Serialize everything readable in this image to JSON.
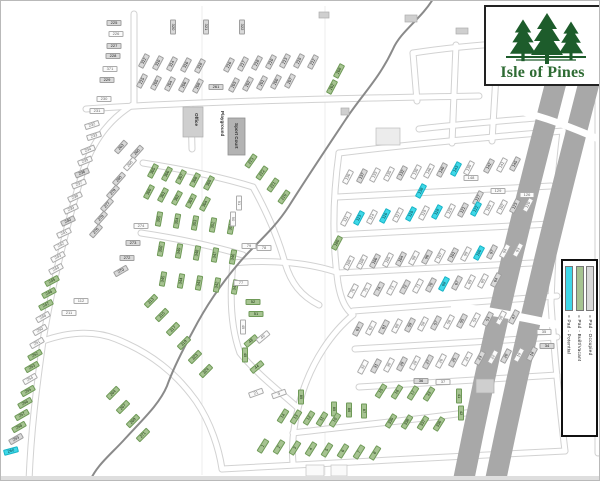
{
  "logo": {
    "title": "Isle of Pines"
  },
  "legend": {
    "items": [
      {
        "label": "= Pad - Potential",
        "type": "p"
      },
      {
        "label": "= Pad - Built/Vacant",
        "type": "b"
      },
      {
        "label": "= Pad - Occupied",
        "type": "o"
      }
    ]
  },
  "facilities": {
    "office": "Office",
    "playground": "Playground",
    "sport_court": "Sport Court"
  },
  "colors": {
    "pad_occupied": "#d9d9d9",
    "pad_occupied_border": "#9f9f9f",
    "pad_built": "#a6c391",
    "pad_built_border": "#6f9a58",
    "pad_potential": "#3fd8e8",
    "pad_potential_border": "#17b4c6",
    "pad_unshaded": "#fbfbfb",
    "pad_unshaded_border": "#ababab",
    "highway": "#a8a8a8",
    "creek": "#8a8a8a",
    "road_edge": "#d2d2d2",
    "logo_green": "#1d5c2b",
    "logo_text": "#2e6b33"
  },
  "lots": [
    [
      "225",
      113,
      22,
      0,
      "o"
    ],
    [
      "226",
      115,
      33,
      0,
      "w"
    ],
    [
      "227",
      113,
      45,
      0,
      "o"
    ],
    [
      "228",
      112,
      55,
      0,
      "o"
    ],
    [
      "371",
      109,
      68,
      0,
      "w"
    ],
    [
      "229",
      106,
      79,
      0,
      "o"
    ],
    [
      "230",
      103,
      98,
      0,
      "w"
    ],
    [
      "231",
      96,
      110,
      0,
      "w"
    ],
    [
      "320",
      172,
      26,
      90,
      "o"
    ],
    [
      "321",
      205,
      26,
      90,
      "o"
    ],
    [
      "322",
      241,
      26,
      90,
      "o"
    ],
    [
      "312",
      143,
      60,
      -62,
      "o"
    ],
    [
      "310",
      157,
      62,
      -62,
      "o"
    ],
    [
      "314",
      171,
      63,
      -62,
      "o"
    ],
    [
      "316",
      185,
      64,
      -62,
      "o"
    ],
    [
      "318",
      199,
      65,
      -62,
      "o"
    ],
    [
      "216",
      228,
      64,
      -62,
      "o"
    ],
    [
      "217",
      242,
      63,
      -62,
      "o"
    ],
    [
      "218",
      256,
      62,
      -62,
      "o"
    ],
    [
      "210",
      270,
      61,
      -62,
      "o"
    ],
    [
      "213",
      284,
      60,
      -62,
      "o"
    ],
    [
      "219",
      298,
      60,
      -62,
      "o"
    ],
    [
      "212",
      312,
      61,
      -62,
      "o"
    ],
    [
      "215",
      141,
      80,
      -62,
      "o"
    ],
    [
      "205",
      155,
      82,
      -62,
      "o"
    ],
    [
      "204",
      169,
      83,
      -62,
      "o"
    ],
    [
      "206",
      183,
      84,
      -62,
      "o"
    ],
    [
      "208",
      197,
      85,
      -62,
      "o"
    ],
    [
      "261",
      215,
      86,
      0,
      "o"
    ],
    [
      "203",
      233,
      84,
      -62,
      "o"
    ],
    [
      "202",
      247,
      83,
      -62,
      "o"
    ],
    [
      "201",
      261,
      82,
      -62,
      "o"
    ],
    [
      "200",
      275,
      81,
      -62,
      "o"
    ],
    [
      "207",
      289,
      80,
      -62,
      "o"
    ],
    [
      "268",
      338,
      70,
      -62,
      "b"
    ],
    [
      "262",
      331,
      86,
      -62,
      "b"
    ],
    [
      "305",
      152,
      170,
      -62,
      "b"
    ],
    [
      "306",
      166,
      173,
      -62,
      "b"
    ],
    [
      "307",
      180,
      176,
      -62,
      "b"
    ],
    [
      "308",
      194,
      179,
      -62,
      "b"
    ],
    [
      "309",
      208,
      182,
      -62,
      "b"
    ],
    [
      "300",
      148,
      191,
      -62,
      "b"
    ],
    [
      "301",
      162,
      194,
      -62,
      "b"
    ],
    [
      "302",
      176,
      197,
      -62,
      "b"
    ],
    [
      "303",
      190,
      200,
      -62,
      "b"
    ],
    [
      "304",
      204,
      203,
      -62,
      "b"
    ],
    [
      "223",
      250,
      160,
      -55,
      "b"
    ],
    [
      "222",
      261,
      172,
      -55,
      "b"
    ],
    [
      "221",
      272,
      184,
      -55,
      "b"
    ],
    [
      "220",
      283,
      196,
      -55,
      "b"
    ],
    [
      "355",
      158,
      218,
      -80,
      "b"
    ],
    [
      "354",
      176,
      220,
      -80,
      "b"
    ],
    [
      "353",
      194,
      222,
      -80,
      "b"
    ],
    [
      "352",
      212,
      224,
      -80,
      "b"
    ],
    [
      "351",
      230,
      226,
      -80,
      "b"
    ],
    [
      "350",
      160,
      248,
      -80,
      "b"
    ],
    [
      "349",
      178,
      250,
      -80,
      "b"
    ],
    [
      "348",
      196,
      252,
      -80,
      "b"
    ],
    [
      "347",
      214,
      254,
      -80,
      "b"
    ],
    [
      "346",
      232,
      256,
      -80,
      "b"
    ],
    [
      "345",
      162,
      278,
      -80,
      "b"
    ],
    [
      "344",
      180,
      280,
      -80,
      "b"
    ],
    [
      "343",
      198,
      282,
      -80,
      "b"
    ],
    [
      "342",
      216,
      284,
      -80,
      "b"
    ],
    [
      "341",
      234,
      286,
      -80,
      "b"
    ],
    [
      "263",
      120,
      146,
      -48,
      "o"
    ],
    [
      "265",
      136,
      151,
      -48,
      "o"
    ],
    [
      "266",
      129,
      163,
      -48,
      "w"
    ],
    [
      "280",
      118,
      178,
      -48,
      "o"
    ],
    [
      "279",
      112,
      191,
      -48,
      "o"
    ],
    [
      "277",
      106,
      204,
      -48,
      "o"
    ],
    [
      "278",
      100,
      217,
      -48,
      "o"
    ],
    [
      "276",
      95,
      230,
      -48,
      "o"
    ],
    [
      "274",
      140,
      225,
      0,
      "w"
    ],
    [
      "273",
      132,
      242,
      0,
      "o"
    ],
    [
      "272",
      126,
      257,
      0,
      "o"
    ],
    [
      "270",
      120,
      270,
      -30,
      "o"
    ],
    [
      "112",
      80,
      300,
      0,
      "w"
    ],
    [
      "211",
      68,
      312,
      0,
      "w"
    ],
    [
      "313",
      150,
      300,
      -45,
      "b"
    ],
    [
      "315",
      161,
      314,
      -45,
      "b"
    ],
    [
      "317",
      172,
      328,
      -45,
      "b"
    ],
    [
      "319",
      183,
      342,
      -45,
      "b"
    ],
    [
      "323",
      194,
      356,
      -45,
      "b"
    ],
    [
      "324",
      205,
      370,
      -45,
      "b"
    ],
    [
      "264",
      112,
      392,
      -45,
      "b"
    ],
    [
      "267",
      122,
      406,
      -45,
      "b"
    ],
    [
      "269",
      132,
      420,
      -45,
      "b"
    ],
    [
      "271",
      142,
      434,
      -45,
      "b"
    ],
    [
      "232",
      91,
      124,
      -18,
      "w"
    ],
    [
      "233",
      93,
      135,
      -18,
      "w"
    ],
    [
      "234",
      87,
      149,
      -22,
      "w"
    ],
    [
      "235",
      84,
      160,
      -22,
      "w"
    ],
    [
      "236",
      81,
      172,
      -22,
      "o"
    ],
    [
      "237",
      78,
      183,
      -22,
      "w"
    ],
    [
      "238",
      74,
      196,
      -25,
      "w"
    ],
    [
      "239",
      70,
      208,
      -25,
      "w"
    ],
    [
      "240",
      67,
      220,
      -25,
      "o"
    ],
    [
      "241",
      63,
      232,
      -25,
      "w"
    ],
    [
      "242",
      60,
      244,
      -28,
      "w"
    ],
    [
      "243",
      57,
      256,
      -28,
      "w"
    ],
    [
      "244",
      55,
      268,
      -28,
      "w"
    ],
    [
      "245",
      51,
      280,
      -28,
      "b"
    ],
    [
      "246",
      48,
      292,
      -28,
      "b"
    ],
    [
      "247",
      45,
      304,
      -28,
      "b"
    ],
    [
      "248",
      42,
      316,
      -30,
      "w"
    ],
    [
      "250",
      39,
      329,
      -30,
      "w"
    ],
    [
      "251",
      36,
      342,
      -30,
      "w"
    ],
    [
      "252",
      34,
      354,
      -30,
      "b"
    ],
    [
      "253",
      31,
      366,
      -30,
      "b"
    ],
    [
      "254",
      29,
      378,
      -30,
      "w"
    ],
    [
      "255",
      27,
      390,
      -30,
      "b"
    ],
    [
      "256",
      24,
      402,
      -30,
      "b"
    ],
    [
      "257",
      21,
      414,
      -30,
      "b"
    ],
    [
      "258",
      18,
      426,
      -30,
      "b"
    ],
    [
      "259",
      15,
      438,
      -30,
      "o"
    ],
    [
      "260",
      10,
      450,
      -15,
      "p"
    ],
    [
      "136",
      347,
      176,
      -62,
      "w"
    ],
    [
      "137",
      361,
      175,
      -62,
      "o"
    ],
    [
      "133",
      374,
      174,
      -62,
      "w"
    ],
    [
      "135",
      388,
      173,
      -62,
      "w"
    ],
    [
      "132",
      401,
      172,
      -62,
      "o"
    ],
    [
      "130",
      415,
      171,
      -62,
      "w"
    ],
    [
      "146",
      428,
      170,
      -62,
      "w"
    ],
    [
      "140",
      441,
      169,
      -62,
      "o"
    ],
    [
      "143",
      455,
      168,
      -62,
      "p"
    ],
    [
      "139",
      468,
      167,
      -62,
      "w"
    ],
    [
      "142",
      488,
      165,
      -62,
      "o"
    ],
    [
      "141",
      501,
      164,
      -62,
      "w"
    ],
    [
      "145",
      514,
      163,
      -62,
      "o"
    ],
    [
      "148",
      470,
      177,
      0,
      "w"
    ],
    [
      "138",
      420,
      190,
      -62,
      "p"
    ],
    [
      "127",
      477,
      197,
      -62,
      "o"
    ],
    [
      "129",
      497,
      190,
      0,
      "w"
    ],
    [
      "126",
      526,
      194,
      0,
      "w"
    ],
    [
      "111",
      345,
      218,
      -62,
      "w"
    ],
    [
      "113",
      358,
      217,
      -62,
      "p"
    ],
    [
      "114",
      371,
      216,
      -62,
      "w"
    ],
    [
      "116",
      384,
      215,
      -62,
      "p"
    ],
    [
      "117",
      397,
      214,
      -62,
      "w"
    ],
    [
      "110",
      410,
      213,
      -62,
      "p"
    ],
    [
      "119",
      423,
      212,
      -62,
      "w"
    ],
    [
      "118",
      436,
      211,
      -62,
      "p"
    ],
    [
      "125",
      449,
      210,
      -62,
      "w"
    ],
    [
      "121",
      462,
      209,
      -62,
      "o"
    ],
    [
      "122",
      475,
      208,
      -62,
      "p"
    ],
    [
      "103",
      488,
      207,
      -62,
      "w"
    ],
    [
      "102",
      501,
      206,
      -62,
      "w"
    ],
    [
      "123",
      514,
      205,
      -62,
      "o"
    ],
    [
      "120",
      527,
      204,
      -62,
      "w"
    ],
    [
      "180",
      336,
      242,
      -62,
      "b"
    ],
    [
      "109",
      348,
      262,
      -62,
      "w"
    ],
    [
      "108",
      361,
      261,
      -62,
      "w"
    ],
    [
      "106",
      374,
      260,
      -62,
      "o"
    ],
    [
      "105",
      387,
      259,
      -62,
      "w"
    ],
    [
      "104",
      400,
      258,
      -62,
      "o"
    ],
    [
      "98",
      413,
      257,
      -62,
      "w"
    ],
    [
      "96",
      426,
      256,
      -62,
      "o"
    ],
    [
      "107",
      439,
      255,
      -62,
      "w"
    ],
    [
      "101",
      452,
      254,
      -62,
      "o"
    ],
    [
      "99",
      465,
      253,
      -62,
      "w"
    ],
    [
      "100",
      478,
      252,
      -62,
      "p"
    ],
    [
      "97",
      491,
      251,
      -62,
      "o"
    ],
    [
      "94",
      504,
      250,
      -62,
      "w"
    ],
    [
      "93",
      517,
      249,
      -62,
      "w"
    ],
    [
      "76",
      352,
      290,
      -62,
      "w"
    ],
    [
      "75",
      365,
      289,
      -62,
      "w"
    ],
    [
      "74",
      378,
      288,
      -62,
      "o"
    ],
    [
      "73",
      391,
      287,
      -62,
      "w"
    ],
    [
      "72",
      404,
      286,
      -62,
      "o"
    ],
    [
      "71",
      417,
      285,
      -62,
      "w"
    ],
    [
      "70",
      430,
      284,
      -62,
      "o"
    ],
    [
      "68",
      443,
      283,
      -62,
      "p"
    ],
    [
      "67",
      456,
      282,
      -62,
      "o"
    ],
    [
      "69",
      469,
      281,
      -62,
      "w"
    ],
    [
      "65",
      482,
      280,
      -62,
      "w"
    ],
    [
      "64",
      495,
      279,
      -62,
      "o"
    ],
    [
      "63",
      357,
      328,
      -62,
      "o"
    ],
    [
      "62",
      370,
      327,
      -62,
      "w"
    ],
    [
      "61",
      383,
      326,
      -62,
      "o"
    ],
    [
      "60",
      396,
      325,
      -62,
      "w"
    ],
    [
      "59",
      409,
      324,
      -62,
      "o"
    ],
    [
      "58",
      422,
      323,
      -62,
      "w"
    ],
    [
      "57",
      435,
      322,
      -62,
      "o"
    ],
    [
      "56",
      448,
      321,
      -62,
      "w"
    ],
    [
      "55",
      461,
      320,
      -62,
      "o"
    ],
    [
      "54",
      474,
      319,
      -62,
      "w"
    ],
    [
      "53",
      487,
      318,
      -62,
      "o"
    ],
    [
      "50",
      500,
      317,
      -62,
      "w"
    ],
    [
      "47",
      513,
      316,
      -62,
      "o"
    ],
    [
      "32",
      362,
      366,
      -62,
      "w"
    ],
    [
      "31",
      375,
      365,
      -62,
      "o"
    ],
    [
      "30",
      388,
      364,
      -62,
      "w"
    ],
    [
      "29",
      401,
      363,
      -62,
      "o"
    ],
    [
      "28",
      414,
      362,
      -62,
      "w"
    ],
    [
      "27",
      427,
      361,
      -62,
      "o"
    ],
    [
      "26",
      440,
      360,
      -62,
      "w"
    ],
    [
      "25",
      453,
      359,
      -62,
      "o"
    ],
    [
      "24",
      466,
      358,
      -62,
      "w"
    ],
    [
      "23",
      479,
      357,
      -62,
      "o"
    ],
    [
      "22",
      492,
      356,
      -62,
      "w"
    ],
    [
      "20",
      505,
      355,
      -62,
      "o"
    ],
    [
      "19",
      518,
      354,
      -62,
      "w"
    ],
    [
      "18",
      531,
      353,
      -62,
      "o"
    ],
    [
      "35",
      543,
      331,
      0,
      "w"
    ],
    [
      "34",
      546,
      345,
      0,
      "o"
    ],
    [
      "91",
      238,
      202,
      90,
      "w"
    ],
    [
      "90",
      232,
      218,
      90,
      "w"
    ],
    [
      "79",
      248,
      245,
      0,
      "w"
    ],
    [
      "78",
      263,
      247,
      0,
      "w"
    ],
    [
      "77",
      240,
      282,
      0,
      "w"
    ],
    [
      "52",
      252,
      301,
      0,
      "b"
    ],
    [
      "51",
      255,
      313,
      0,
      "b"
    ],
    [
      "49",
      242,
      326,
      90,
      "w"
    ],
    [
      "48",
      250,
      340,
      -40,
      "b"
    ],
    [
      "46",
      262,
      336,
      -40,
      "w"
    ],
    [
      "45",
      244,
      354,
      90,
      "b"
    ],
    [
      "44",
      256,
      366,
      -40,
      "b"
    ],
    [
      "21",
      255,
      392,
      -20,
      "w"
    ],
    [
      "9",
      278,
      393,
      -20,
      "w"
    ],
    [
      "89",
      300,
      396,
      90,
      "b"
    ],
    [
      "85",
      333,
      408,
      90,
      "b"
    ],
    [
      "86",
      348,
      409,
      90,
      "b"
    ],
    [
      "87",
      363,
      410,
      90,
      "b"
    ],
    [
      "14",
      282,
      415,
      -58,
      "b"
    ],
    [
      "13",
      295,
      416,
      -58,
      "b"
    ],
    [
      "12",
      308,
      417,
      -58,
      "b"
    ],
    [
      "11",
      321,
      418,
      -58,
      "b"
    ],
    [
      "10",
      334,
      419,
      -58,
      "b"
    ],
    [
      "1",
      262,
      445,
      -58,
      "b"
    ],
    [
      "2",
      278,
      446,
      -58,
      "b"
    ],
    [
      "3",
      294,
      447,
      -58,
      "b"
    ],
    [
      "4",
      310,
      448,
      -58,
      "b"
    ],
    [
      "5",
      326,
      449,
      -58,
      "b"
    ],
    [
      "6",
      342,
      450,
      -58,
      "b"
    ],
    [
      "7",
      358,
      451,
      -58,
      "b"
    ],
    [
      "8",
      374,
      452,
      -58,
      "b"
    ],
    [
      "15",
      380,
      390,
      -58,
      "b"
    ],
    [
      "16",
      396,
      391,
      -58,
      "b"
    ],
    [
      "17",
      412,
      392,
      -58,
      "b"
    ],
    [
      "33",
      428,
      393,
      -58,
      "b"
    ],
    [
      "339",
      390,
      420,
      -58,
      "b"
    ],
    [
      "338",
      406,
      421,
      -58,
      "b"
    ],
    [
      "337",
      422,
      422,
      -58,
      "b"
    ],
    [
      "336",
      438,
      423,
      -58,
      "b"
    ],
    [
      "36",
      420,
      380,
      0,
      "o"
    ],
    [
      "37",
      442,
      381,
      0,
      "w"
    ],
    [
      "41",
      458,
      395,
      90,
      "b"
    ],
    [
      "42",
      460,
      412,
      90,
      "b"
    ]
  ]
}
